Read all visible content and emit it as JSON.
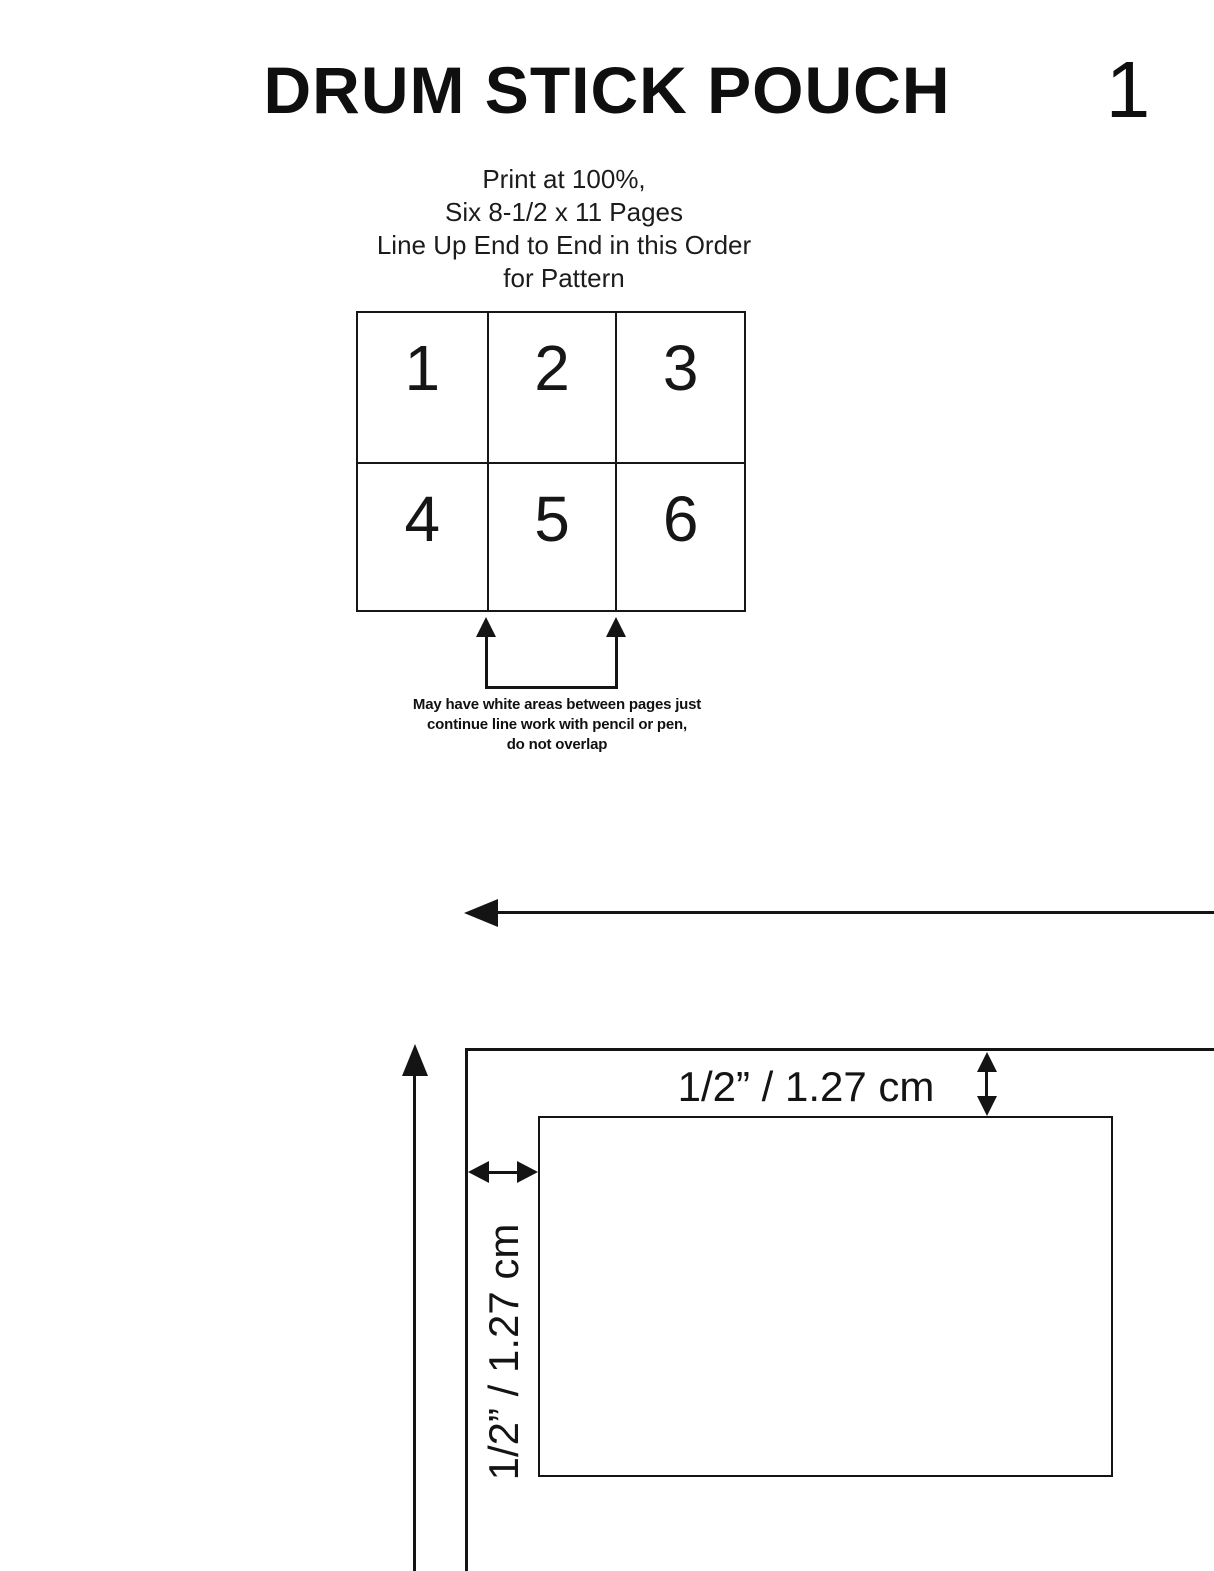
{
  "header": {
    "title": "DRUM STICK POUCH",
    "page_number": "1"
  },
  "instructions": {
    "lines": [
      "Print at 100%,",
      "Six 8-1/2 x 11 Pages",
      "Line Up End to End in this Order",
      "for Pattern"
    ]
  },
  "page_order_grid": {
    "rows": 2,
    "columns": 3,
    "cells": [
      "1",
      "2",
      "3",
      "4",
      "5",
      "6"
    ]
  },
  "note": {
    "lines": [
      "May have white areas between pages just",
      "continue line work with pencil or pen,",
      "do not overlap"
    ]
  },
  "measurements": {
    "top_seam_allowance": "1/2” / 1.27 cm",
    "left_seam_allowance": "1/2” / 1.27 cm"
  },
  "icons": {
    "join_arrows": "two up arrows pointing at page join lines",
    "direction_arrow": "long arrow pointing left",
    "grain_arrow": "long arrow pointing up",
    "seam_arrow_vertical": "double-headed vertical arrow",
    "seam_arrow_horizontal": "double-headed horizontal arrow"
  },
  "colors": {
    "ink": "#141414",
    "background": "#ffffff"
  }
}
